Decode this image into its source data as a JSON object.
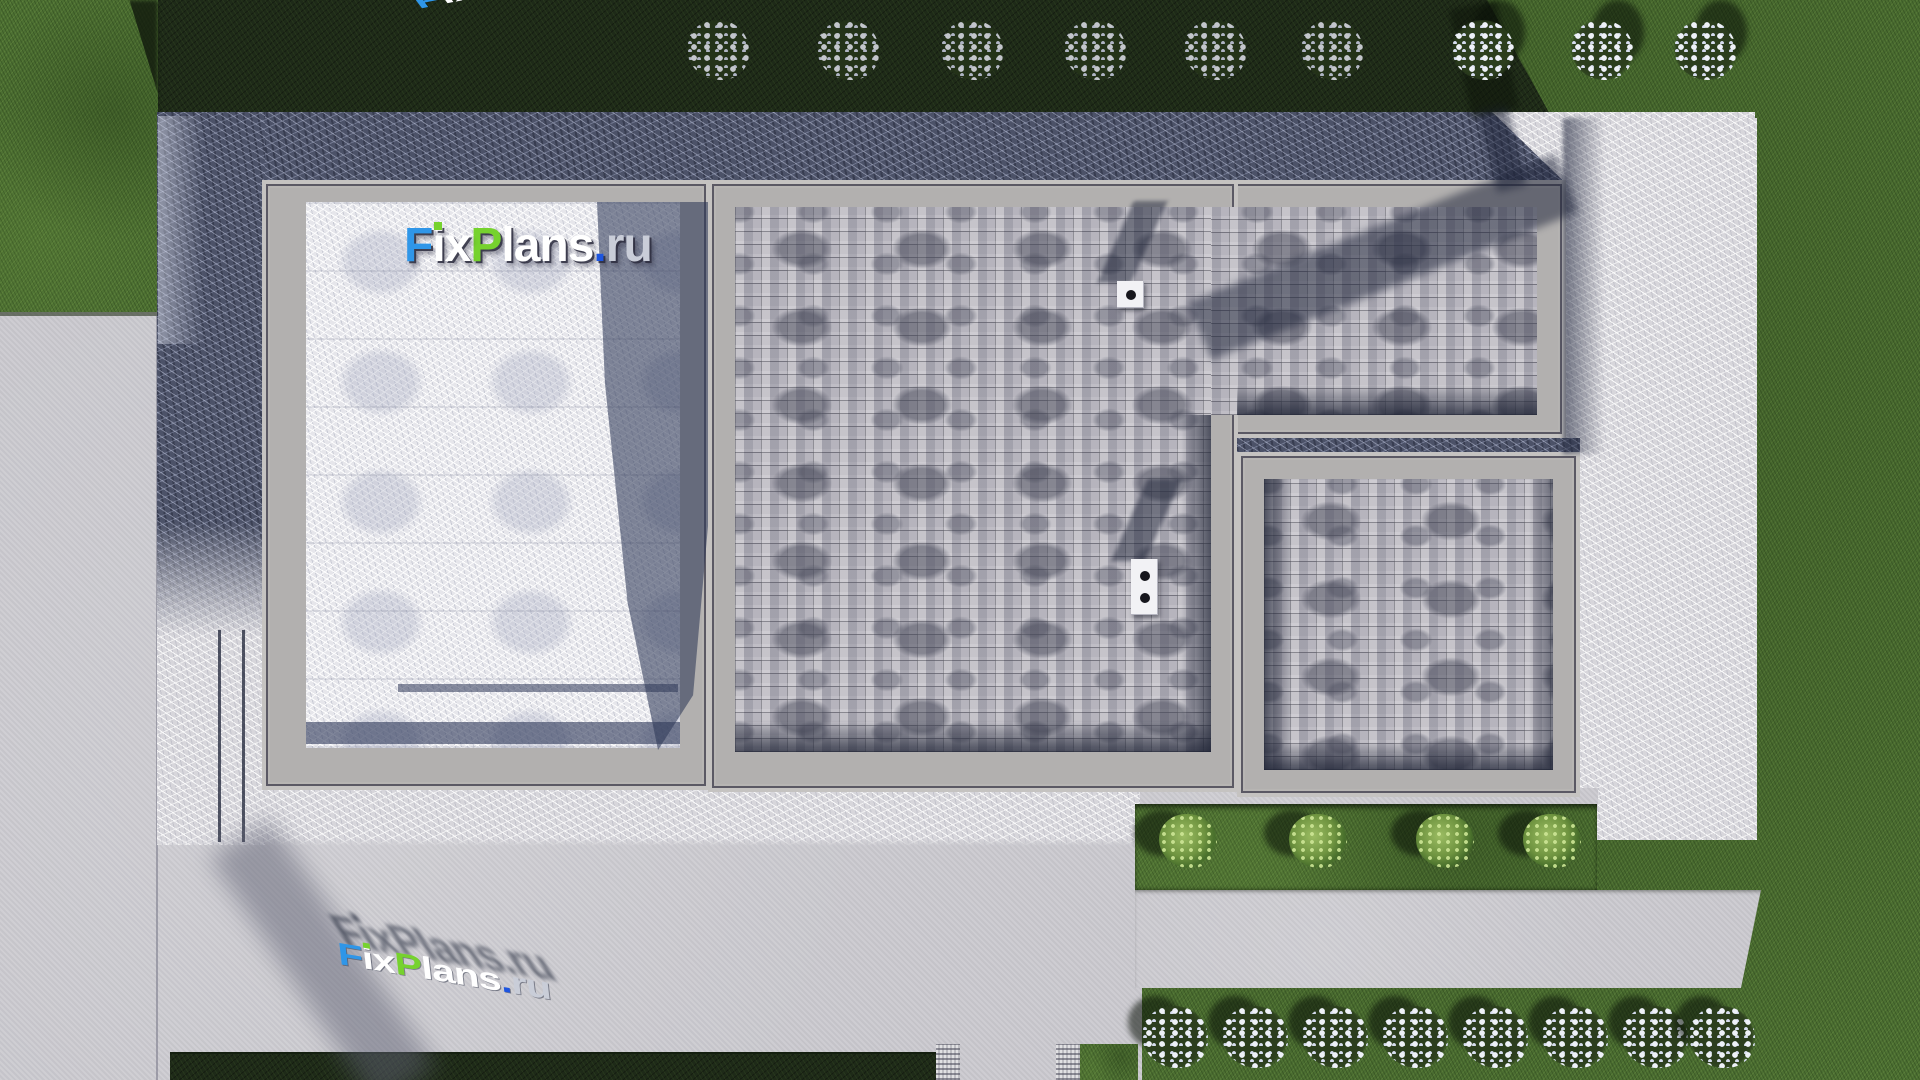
{
  "watermark": {
    "f": "F",
    "ix": "ix",
    "p": "P",
    "lans": "lans",
    "dot": ".",
    "ru": "ru"
  },
  "brand_colors": {
    "blue": "#2f96e8",
    "green": "#76d22e",
    "dot_blue": "#1d55e0",
    "ru_gray": "#c9cdd8",
    "white": "#ffffff"
  },
  "palette": {
    "grass_sun": "#4d7033",
    "grass_dark": "#1e2a18",
    "concrete_light": "#cbcacf",
    "concrete_tex": "#d7d6db",
    "concrete_shadow": "#4c5268",
    "frame": "#b2b0af",
    "shingle": "#b9b7bf"
  },
  "landscape": {
    "top_bushes_x": [
      718,
      848,
      972,
      1095,
      1215,
      1332,
      1483,
      1602,
      1705
    ],
    "green_bushes_x": [
      1188,
      1318,
      1445,
      1552
    ],
    "bottom_bushes_x": [
      1175,
      1255,
      1335,
      1415,
      1495,
      1575,
      1655,
      1722
    ],
    "chimneys": [
      {
        "x": 1117,
        "y": 281,
        "w": 27,
        "h": 27,
        "holes": 1
      },
      {
        "x": 1131,
        "y": 559,
        "w": 27,
        "h": 56,
        "holes": 2
      }
    ]
  }
}
